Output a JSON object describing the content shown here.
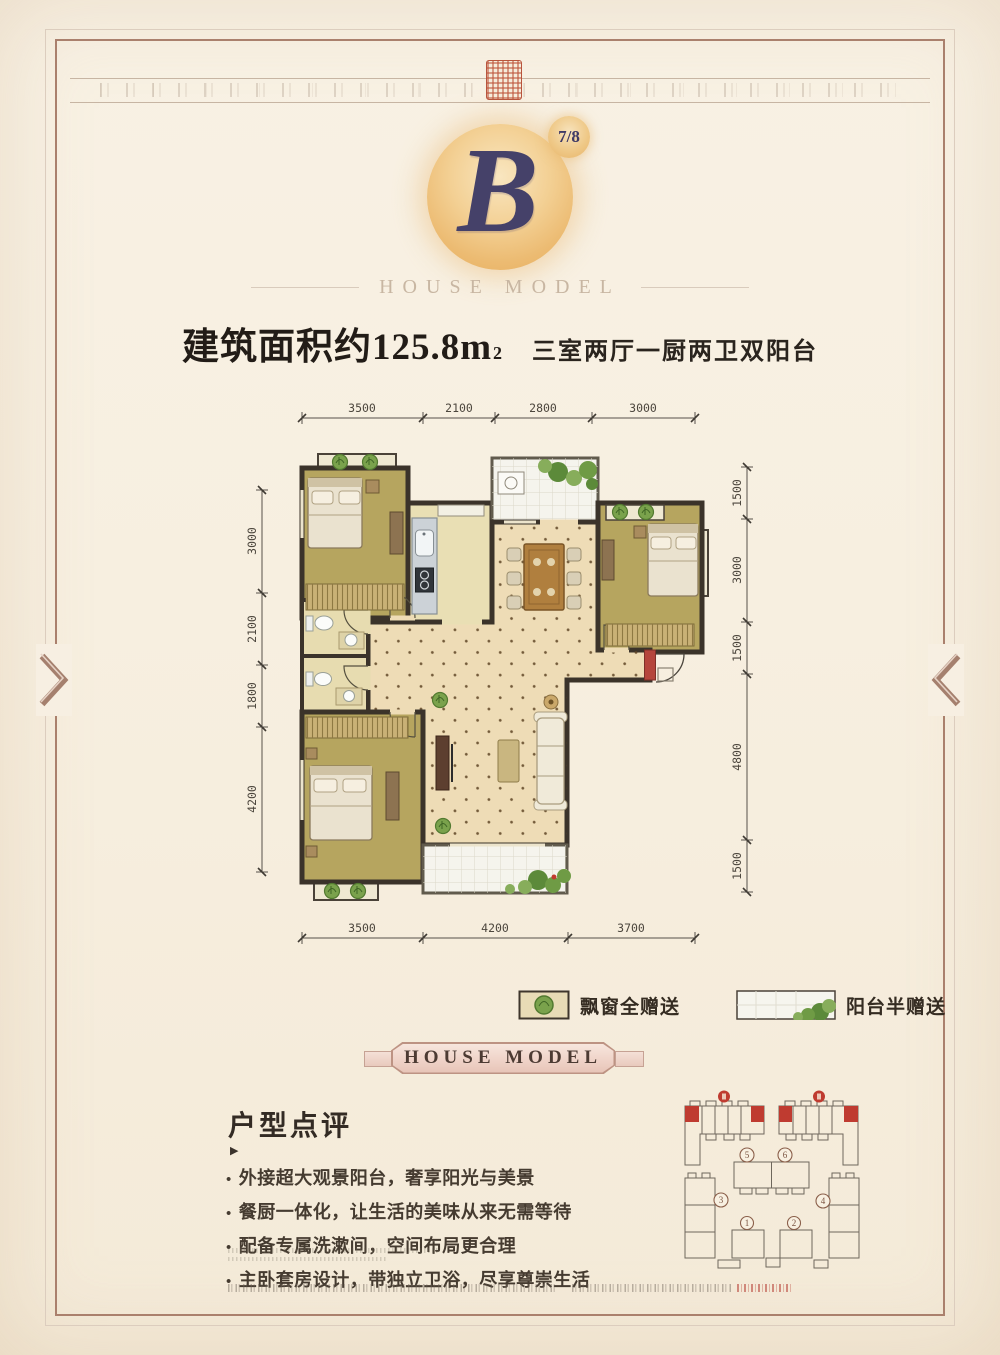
{
  "header": {
    "badge": "7/8",
    "logo_letter": "B",
    "brand": "HOUSE MODEL"
  },
  "title": {
    "area_text": "建筑面积约125.8m",
    "area_sup": "2",
    "layout": "三室两厅一厨两卫双阳台"
  },
  "floor_plan": {
    "dims_top": [
      "3500",
      "2100",
      "2800",
      "3000"
    ],
    "dims_bottom": [
      "3500",
      "4200",
      "3700"
    ],
    "dims_left": [
      "3000",
      "2100",
      "1800",
      "4200"
    ],
    "dims_right": [
      "1500",
      "3000",
      "1500",
      "4800",
      "1500"
    ]
  },
  "legend": {
    "bay_window_label": "飘窗全赠送",
    "balcony_label": "阳台半赠送"
  },
  "banner": {
    "text": "HOUSE MODEL"
  },
  "review": {
    "heading": "户型点评",
    "marker": "▶",
    "bullets": [
      "外接超大观景阳台，奢享阳光与美景",
      "餐厨一体化，让生活的美味从来无需等待",
      "配备专属洗漱间，空间布局更合理",
      "主卧套房设计，带独立卫浴，尽享尊崇生活"
    ]
  },
  "site_plan": {
    "building_labels": [
      "1",
      "2",
      "3",
      "4",
      "5",
      "6"
    ]
  },
  "colors": {
    "frame": "#aa806d",
    "accent_red": "#b5453c",
    "gold": "#ecbb72",
    "logo_navy": "#454169",
    "wall": "#3b332a",
    "room_olive": "#b6a55f",
    "floor_cream": "#eedcb6"
  }
}
